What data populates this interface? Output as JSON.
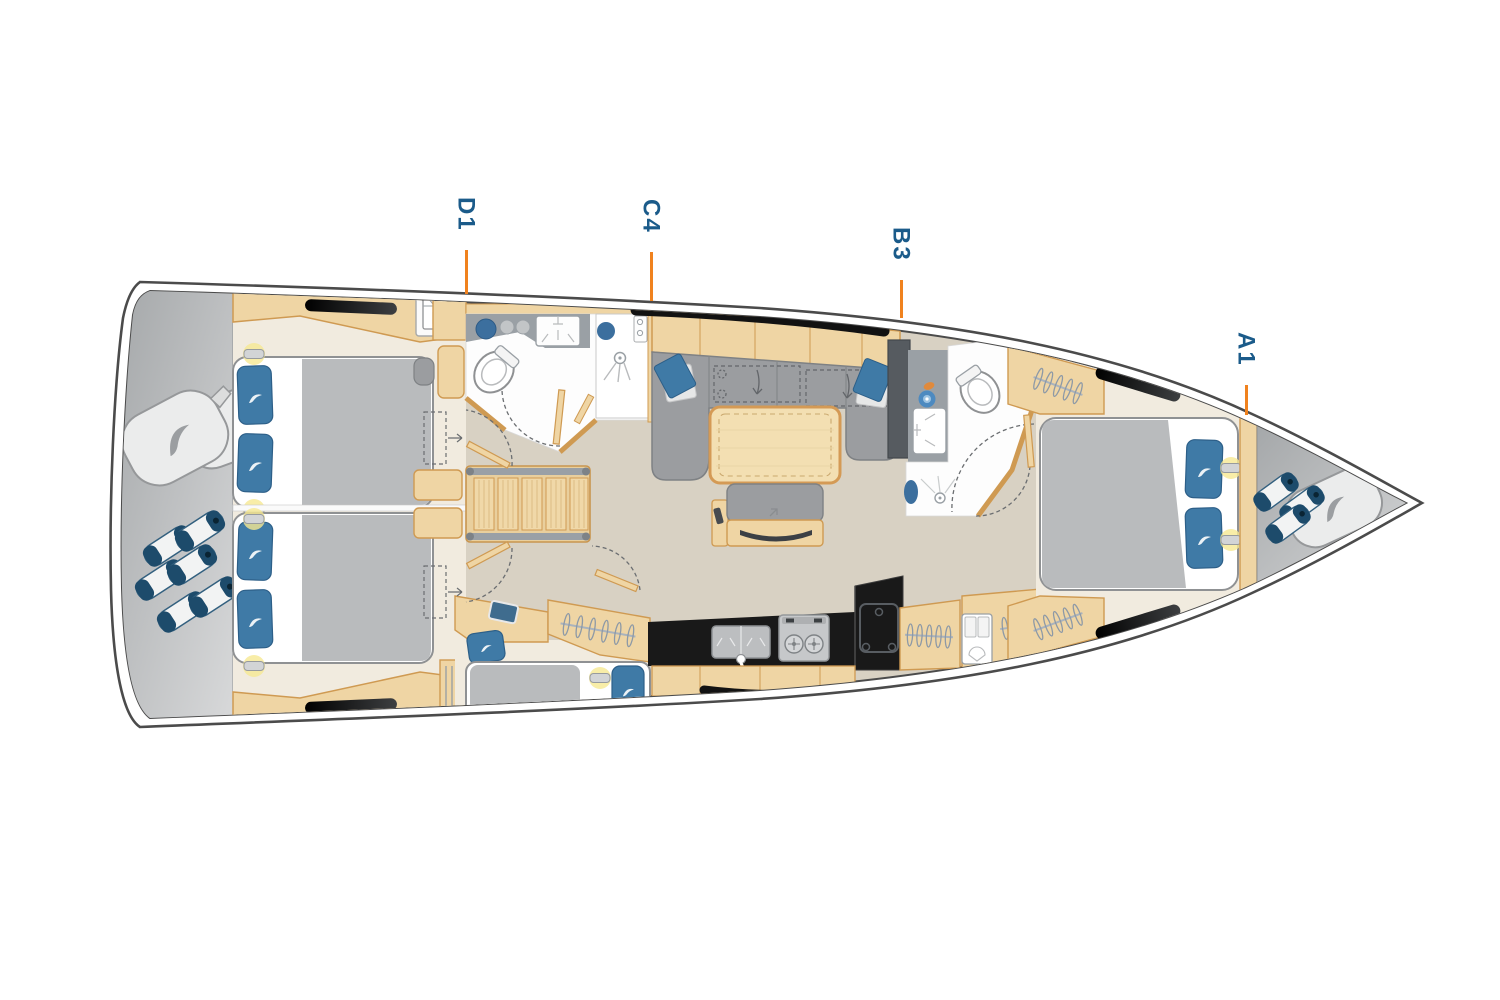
{
  "plan": {
    "type": "yacht-interior-deck-plan",
    "cabin_labels": [
      {
        "id": "D1",
        "text": "D1"
      },
      {
        "id": "C4",
        "text": "C4"
      },
      {
        "id": "B3",
        "text": "B3"
      },
      {
        "id": "A1",
        "text": "A1"
      }
    ],
    "colors": {
      "label_text": "#1b5b8a",
      "leader_line": "#f0821e",
      "hull_outline": "#4b4b4b",
      "deck_gray_dark": "#a3a6a8",
      "deck_gray_light": "#d6d7d8",
      "floor_taupe": "#d8d1c3",
      "floor_cream": "#f1ebdf",
      "wood_fill": "#efd5a4",
      "wood_light": "#f3e0ba",
      "wood_border": "#cf9a52",
      "upholstery_gray": "#9b9da0",
      "mattress_gray": "#b9bbbd",
      "cushion_blue": "#3f7aa6",
      "fender_navy": "#1d4b6b",
      "counter_black": "#191919",
      "bath_counter_gray": "#9aa0a5",
      "bath_cabinet_dark": "#565b60",
      "hatch_black": "#141414",
      "glow_yellow": "#f6e892"
    },
    "icons": {
      "toilet-icon": "ellipse-bowl",
      "sink-icon": "basin-rectangle",
      "shower-icon": "spray-head",
      "stove-icon": "two-burner-hob",
      "fridge-icon": "door-outline",
      "tv-icon": "curved-screen",
      "hanging-locker-icon": "hanger-rail",
      "folded-shirt-icon": "shirt",
      "fender-icon": "striped-cylinder",
      "fender-bag-icon": "soft-bag",
      "reading-light-icon": "glow-lamp",
      "door-swing-icon": "dashed-arc",
      "convertible-berth-icon": "dashed-rect-arrow",
      "brand-swoosh-icon": "sail-swoosh"
    }
  }
}
